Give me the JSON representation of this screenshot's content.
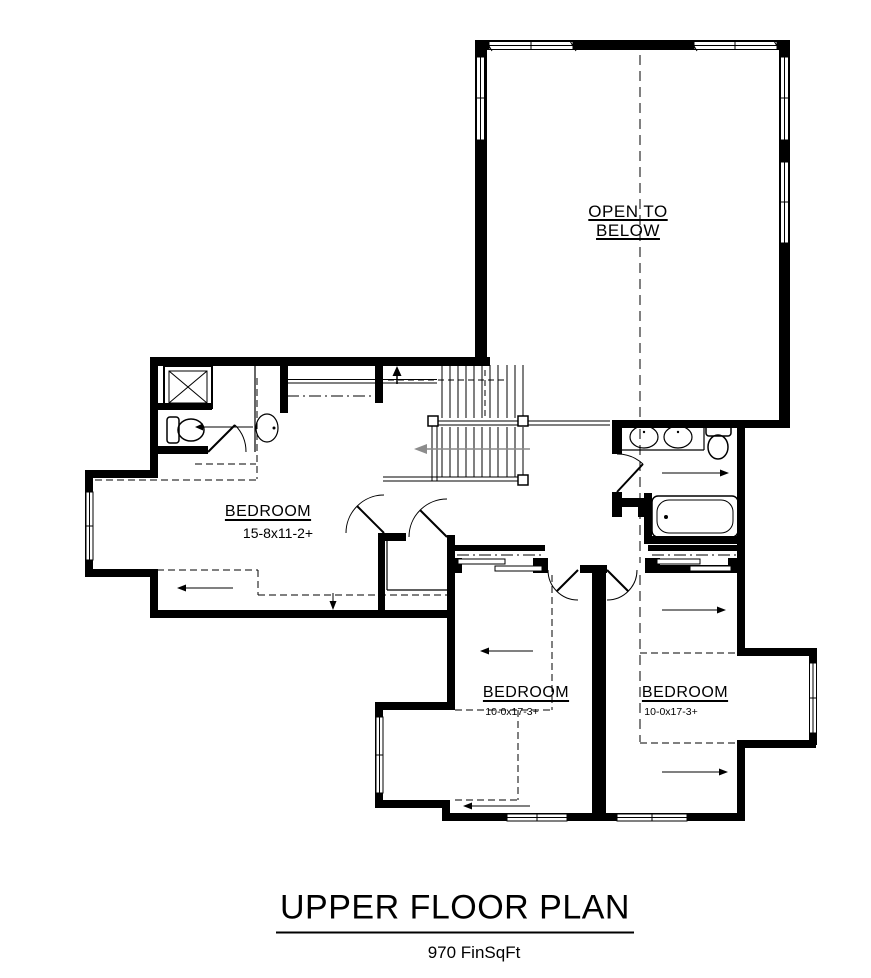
{
  "floor_plan": {
    "open_to_below": {
      "line1": "OPEN TO",
      "line2": "BELOW"
    },
    "master_bedroom": {
      "label": "BEDROOM",
      "dims": "15-8x11-2+"
    },
    "bedroom_left": {
      "label": "BEDROOM",
      "dims": "10-0x17-3+"
    },
    "bedroom_right": {
      "label": "BEDROOM",
      "dims": "10-0x17-3+"
    },
    "title": "UPPER FLOOR PLAN",
    "subtitle": "970 FinSqFt",
    "colors": {
      "wall": "#000000",
      "background": "#ffffff",
      "stair_arrow": "#8c8c8c"
    }
  }
}
